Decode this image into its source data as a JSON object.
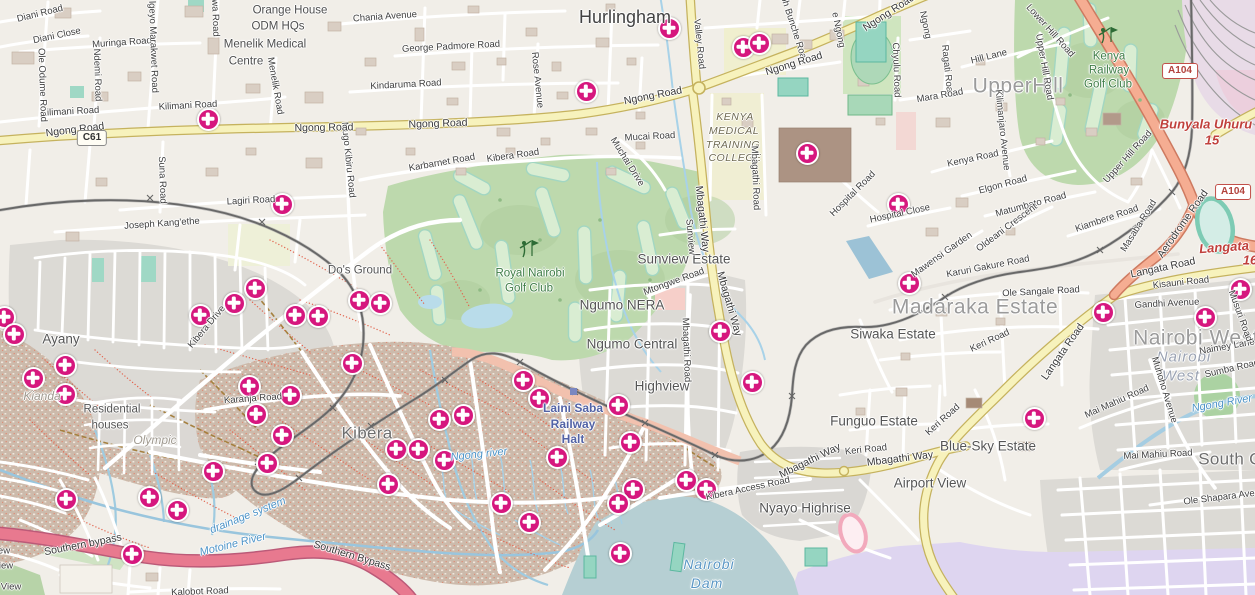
{
  "label_format": [
    "text",
    "x",
    "y",
    "rotate_deg",
    "class"
  ],
  "colors": {
    "marker": "#d6177e",
    "primary_road": "#f7f2bc",
    "trunk_road": "#f5ad92",
    "bypass_road": "#e8798f",
    "golf_green": "#bdd9ad",
    "water": "#aecfdb",
    "estate_gray": "#dcdad5",
    "kibera_brown": "#ccbaab"
  },
  "badges": [
    {
      "t": "A104",
      "x": 1180,
      "y": 71,
      "s": "trunk"
    },
    {
      "t": "A104",
      "x": 1233,
      "y": 192,
      "s": "trunk"
    },
    {
      "t": "C61",
      "x": 92,
      "y": 138,
      "s": "ref"
    }
  ],
  "labels": [
    [
      "Hurlingham",
      625,
      17,
      0,
      "place-hl"
    ],
    [
      "UpperHill",
      1018,
      86,
      0,
      "place-xl"
    ],
    [
      "Madaraka Estate",
      975,
      307,
      0,
      "place-xl"
    ],
    [
      "Nairobi West",
      1196,
      338,
      0,
      "place-xl"
    ],
    [
      "South C",
      1230,
      459,
      0,
      "place-lg"
    ],
    [
      "Kibera",
      367,
      433,
      0,
      "place-lg"
    ],
    [
      "Ayany",
      61,
      339,
      0,
      "place"
    ],
    [
      "Sunview Estate",
      684,
      259,
      0,
      "place"
    ],
    [
      "Ngumo NERA",
      622,
      305,
      0,
      "place"
    ],
    [
      "Ngumo Central",
      632,
      344,
      0,
      "place"
    ],
    [
      "Highview",
      662,
      386,
      0,
      "place"
    ],
    [
      "Siwaka Estate",
      893,
      334,
      0,
      "place"
    ],
    [
      "Funguo Estate",
      874,
      421,
      0,
      "place"
    ],
    [
      "Blue-Sky Estate",
      988,
      446,
      0,
      "place"
    ],
    [
      "Airport View",
      930,
      483,
      0,
      "place"
    ],
    [
      "Nyayo Highrise",
      805,
      508,
      0,
      "place"
    ],
    [
      "Residential",
      112,
      410,
      0,
      "place-sm"
    ],
    [
      "houses",
      110,
      426,
      0,
      "place-sm"
    ],
    [
      "Do's Ground",
      360,
      271,
      0,
      "place-sm"
    ],
    [
      "Orange House",
      290,
      11,
      0,
      "poi"
    ],
    [
      "ODM HQs",
      278,
      27,
      0,
      "poi"
    ],
    [
      "Menelik Medical",
      265,
      45,
      0,
      "poi"
    ],
    [
      "Centre",
      246,
      62,
      0,
      "poi"
    ],
    [
      "KENYA",
      735,
      117,
      0,
      "kmtc"
    ],
    [
      "MEDICAL",
      734,
      131,
      0,
      "kmtc"
    ],
    [
      "TRAINING",
      733,
      145,
      0,
      "kmtc"
    ],
    [
      "COLLEGE",
      735,
      158,
      0,
      "kmtc"
    ],
    [
      "Kenya",
      1109,
      57,
      0,
      "golf"
    ],
    [
      "Railway",
      1109,
      71,
      0,
      "golf"
    ],
    [
      "Golf Club",
      1108,
      85,
      0,
      "golf"
    ],
    [
      "Royal Nairobi",
      530,
      274,
      0,
      "golf"
    ],
    [
      "Golf Club",
      529,
      289,
      0,
      "golf"
    ],
    [
      "Laini Saba",
      573,
      408,
      0,
      "station"
    ],
    [
      "Railway",
      573,
      424,
      0,
      "station"
    ],
    [
      "Halt",
      573,
      439,
      0,
      "station"
    ],
    [
      "Nairobi",
      709,
      564,
      0,
      "water-lg"
    ],
    [
      "Dam",
      707,
      583,
      0,
      "water-lg"
    ],
    [
      "Ngong river",
      479,
      455,
      -6,
      "water"
    ],
    [
      "Ngong River",
      1222,
      404,
      -10,
      "water"
    ],
    [
      "Motoine River",
      233,
      545,
      -14,
      "water"
    ],
    [
      "drainage system",
      248,
      516,
      -22,
      "water"
    ],
    [
      "Olympic",
      155,
      440,
      0,
      "wm"
    ],
    [
      "Kianda",
      42,
      396,
      0,
      "wm"
    ],
    [
      "Nairobi",
      1184,
      357,
      0,
      "wm-lg"
    ],
    [
      "West",
      1181,
      376,
      0,
      "wm-lg"
    ],
    [
      "Bunyala Uhuru",
      1206,
      124,
      0,
      "red"
    ],
    [
      "15",
      1212,
      140,
      0,
      "red"
    ],
    [
      "Langata",
      1224,
      247,
      -4,
      "red"
    ],
    [
      "16",
      1250,
      260,
      0,
      "red"
    ],
    [
      "Diani Road",
      40,
      14,
      -14,
      "road"
    ],
    [
      "Diani Close",
      57,
      36,
      -12,
      "road"
    ],
    [
      "Muringa Road",
      122,
      43,
      -4,
      "road"
    ],
    [
      "Kilimani Road",
      70,
      112,
      -3,
      "road"
    ],
    [
      "Kilimani Road",
      188,
      106,
      -3,
      "road"
    ],
    [
      "Chania Avenue",
      385,
      17,
      -4,
      "road"
    ],
    [
      "George Padmore Road",
      451,
      47,
      -3,
      "road"
    ],
    [
      "Kindaruma Road",
      406,
      85,
      -3,
      "road"
    ],
    [
      "Ole Odume Road",
      42,
      85,
      88,
      "road"
    ],
    [
      "Ndemi Road",
      97,
      75,
      88,
      "road"
    ],
    [
      "lgeyo Marakwet Road",
      153,
      47,
      88,
      "road"
    ],
    [
      "wa Road",
      215,
      18,
      88,
      "road"
    ],
    [
      "Menelik Road",
      275,
      86,
      80,
      "road"
    ],
    [
      "Rose Avenue",
      537,
      80,
      84,
      "road"
    ],
    [
      "Mugo Kibiru Road",
      348,
      160,
      84,
      "road"
    ],
    [
      "Suna Road",
      162,
      180,
      88,
      "road"
    ],
    [
      "Lagiri Road",
      251,
      201,
      -3,
      "road"
    ],
    [
      "Joseph Kang'ethe",
      162,
      224,
      -4,
      "road"
    ],
    [
      "Karbarnet Road",
      442,
      163,
      -10,
      "road"
    ],
    [
      "Kibera Road",
      513,
      156,
      -8,
      "road"
    ],
    [
      "Mucai Road",
      650,
      137,
      -3,
      "road"
    ],
    [
      "Muchai Drive",
      627,
      162,
      58,
      "road"
    ],
    [
      "Valley Road",
      699,
      44,
      84,
      "road"
    ],
    [
      "ph Bunche Road",
      794,
      30,
      72,
      "road"
    ],
    [
      "e Ngong",
      838,
      30,
      78,
      "road"
    ],
    [
      "Ngong",
      925,
      25,
      78,
      "road"
    ],
    [
      "Mtongwe Road",
      674,
      282,
      -20,
      "road"
    ],
    [
      "Sunview",
      690,
      237,
      85,
      "road"
    ],
    [
      "Mbagathi Road",
      686,
      350,
      88,
      "road"
    ],
    [
      "Mbagathi Road",
      755,
      178,
      88,
      "road"
    ],
    [
      "Kibera Drive",
      207,
      327,
      -50,
      "road"
    ],
    [
      "Karanja Road",
      253,
      399,
      -4,
      "road"
    ],
    [
      "Kibera Access Road",
      748,
      489,
      -12,
      "road"
    ],
    [
      "Kalobot Road",
      200,
      592,
      -2,
      "road"
    ],
    [
      "ew",
      4,
      551,
      0,
      "road"
    ],
    [
      "iew",
      6,
      566,
      0,
      "road"
    ],
    [
      "View",
      11,
      587,
      0,
      "road"
    ],
    [
      "Hospital Road",
      853,
      194,
      -45,
      "road"
    ],
    [
      "Hospital Close",
      900,
      214,
      -12,
      "road"
    ],
    [
      "Mawensi Garden",
      942,
      255,
      -35,
      "road"
    ],
    [
      "Elgon Road",
      1003,
      185,
      -15,
      "road"
    ],
    [
      "Matumbato Road",
      1031,
      205,
      -15,
      "road"
    ],
    [
      "Oldeani Crescent",
      1007,
      228,
      -37,
      "road"
    ],
    [
      "Kiambere Road",
      1107,
      219,
      -19,
      "road"
    ],
    [
      "Karuri Gakure Road",
      988,
      267,
      -11,
      "road"
    ],
    [
      "Ole Sangale Road",
      1041,
      292,
      -3,
      "road"
    ],
    [
      "Keri Road",
      990,
      341,
      -25,
      "road"
    ],
    [
      "Keri Road",
      943,
      420,
      -42,
      "road"
    ],
    [
      "Keri Road",
      866,
      450,
      -6,
      "road"
    ],
    [
      "Kisauni Road",
      1181,
      283,
      -6,
      "road"
    ],
    [
      "Gandhi Avenue",
      1167,
      304,
      -3,
      "road"
    ],
    [
      "Naimey Lane",
      1227,
      347,
      -10,
      "road"
    ],
    [
      "Sumba Road",
      1232,
      369,
      -13,
      "road"
    ],
    [
      "Musuri Road",
      1240,
      316,
      70,
      "road"
    ],
    [
      "Muhoho Avenue",
      1164,
      390,
      73,
      "road"
    ],
    [
      "Mai Mahiu Road",
      1117,
      402,
      -24,
      "road"
    ],
    [
      "Mai Mahiu Road",
      1158,
      455,
      -3,
      "road"
    ],
    [
      "Ole Shapara Avenue",
      1227,
      497,
      -7,
      "road"
    ],
    [
      "Hill Lane",
      989,
      57,
      -14,
      "road"
    ],
    [
      "Kenya Road",
      973,
      159,
      -12,
      "road"
    ],
    [
      "Kilimanjaro Avenue",
      1002,
      130,
      84,
      "road"
    ],
    [
      "Ragati Road",
      947,
      71,
      84,
      "road"
    ],
    [
      "Mara Road",
      940,
      96,
      -10,
      "road"
    ],
    [
      "Chyulu Road",
      896,
      70,
      88,
      "road"
    ],
    [
      "Upper Hill Road",
      1044,
      67,
      80,
      "road"
    ],
    [
      "Upper Hill Road",
      1128,
      157,
      -48,
      "road"
    ],
    [
      "Lower Hill Road",
      1050,
      31,
      48,
      "road"
    ],
    [
      "Masaba Road",
      1139,
      226,
      -58,
      "road"
    ],
    [
      "Ngong Road",
      75,
      130,
      -7,
      "road-y"
    ],
    [
      "Ngong Road",
      324,
      128,
      -1,
      "road-y"
    ],
    [
      "Ngong Road",
      438,
      124,
      -2,
      "road-y"
    ],
    [
      "Ngong Road",
      653,
      96,
      -11,
      "road-y"
    ],
    [
      "Ngong Road",
      794,
      64,
      -17,
      "road-y"
    ],
    [
      "Ngong Road",
      889,
      13,
      -33,
      "road-y"
    ],
    [
      "Mbagathi Way",
      702,
      219,
      84,
      "road-y"
    ],
    [
      "Mbagathi Way",
      729,
      304,
      74,
      "road-y"
    ],
    [
      "Mbagathi Way",
      810,
      461,
      -26,
      "road-y"
    ],
    [
      "Mbagathi Way",
      900,
      459,
      -7,
      "road-y"
    ],
    [
      "Langata Road",
      1163,
      268,
      -12,
      "road-y"
    ],
    [
      "Langata Road",
      1063,
      352,
      -55,
      "road-y"
    ],
    [
      "Aerodrome Road",
      1183,
      224,
      -55,
      "road-y"
    ],
    [
      "Southern bypass",
      83,
      545,
      -11,
      "road-y"
    ],
    [
      "Southern Bypass",
      352,
      556,
      17,
      "road-y"
    ]
  ],
  "markers": [
    [
      207,
      118
    ],
    [
      281,
      203
    ],
    [
      585,
      90
    ],
    [
      668,
      27
    ],
    [
      742,
      46
    ],
    [
      758,
      42
    ],
    [
      806,
      152
    ],
    [
      897,
      203
    ],
    [
      908,
      282
    ],
    [
      719,
      330
    ],
    [
      751,
      381
    ],
    [
      1102,
      311
    ],
    [
      1204,
      316
    ],
    [
      1239,
      288
    ],
    [
      1033,
      417
    ],
    [
      3,
      316
    ],
    [
      13,
      333
    ],
    [
      64,
      364
    ],
    [
      32,
      377
    ],
    [
      64,
      393
    ],
    [
      199,
      314
    ],
    [
      233,
      302
    ],
    [
      254,
      287
    ],
    [
      294,
      314
    ],
    [
      317,
      315
    ],
    [
      358,
      299
    ],
    [
      379,
      302
    ],
    [
      248,
      385
    ],
    [
      289,
      394
    ],
    [
      255,
      413
    ],
    [
      281,
      434
    ],
    [
      266,
      462
    ],
    [
      212,
      470
    ],
    [
      65,
      498
    ],
    [
      148,
      496
    ],
    [
      176,
      509
    ],
    [
      131,
      553
    ],
    [
      351,
      362
    ],
    [
      395,
      448
    ],
    [
      417,
      448
    ],
    [
      438,
      418
    ],
    [
      462,
      414
    ],
    [
      443,
      459
    ],
    [
      387,
      483
    ],
    [
      500,
      502
    ],
    [
      528,
      521
    ],
    [
      522,
      379
    ],
    [
      538,
      397
    ],
    [
      556,
      456
    ],
    [
      617,
      404
    ],
    [
      629,
      441
    ],
    [
      632,
      488
    ],
    [
      617,
      502
    ],
    [
      619,
      552
    ],
    [
      685,
      479
    ],
    [
      705,
      488
    ]
  ]
}
